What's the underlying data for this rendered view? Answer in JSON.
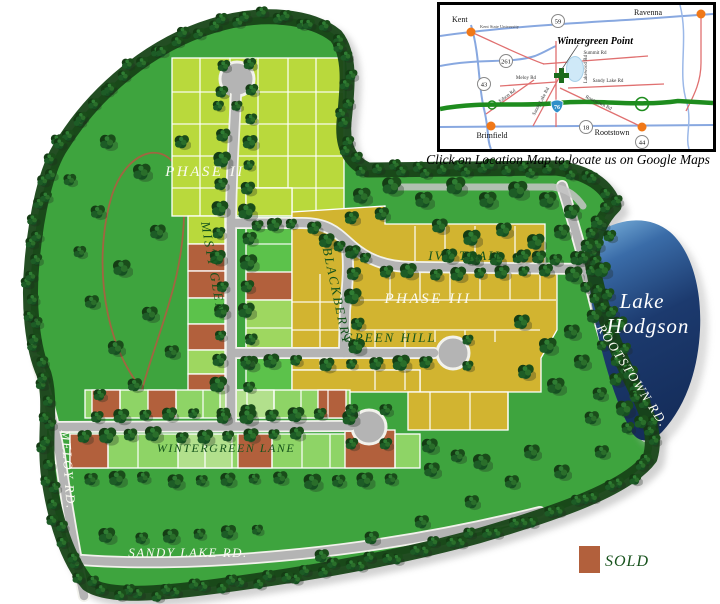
{
  "site_plan": {
    "phase2_label": "PHASE II",
    "phase3_label": "PHASE III",
    "streets": {
      "misty_glen": "MISTY GLEN",
      "blackberry": "BLACKBERRY",
      "ivy_trail": "IVY  TRAIL",
      "green_hill": "GREEN  HILL",
      "wintergreen_lane": "WINTERGREEN  LANE",
      "meloy_rd": "MELOY  RD.",
      "sandy_lake_rd": "SANDY  LAKE  RD.",
      "rootstown_rd": "ROOTSTOWN  RD."
    },
    "lake": {
      "line1": "Lake",
      "line2": "Hodgson"
    },
    "legend": {
      "sold_label": "SOLD",
      "sold_color": "#b2603c"
    },
    "colors": {
      "grass": "#3ea43e",
      "phase2_light": "#b9d93c",
      "phase2_green": "#5cc24b",
      "phase3_gold": "#d2b430",
      "sold": "#b2603c",
      "lake_blue": "#1c3a6b",
      "road_gray": "#b4b4b4"
    }
  },
  "location_map": {
    "caption": "Click on Location Map to locate us on Google Maps",
    "title": "Wintergreen Point",
    "cities": {
      "kent": "Kent",
      "ravenna": "Ravenna",
      "brimfield": "Brimfield",
      "rootstown": "Rootstown"
    },
    "landmark": "Kent State University",
    "roads": {
      "summit": "Summit Rd",
      "meloy": "Meloy Rd",
      "sandy_lake_e": "Sandy Lake Rd",
      "sandy_lake_n": "Sandy Lake Rd",
      "lakewood": "Lakewood Rd",
      "edson": "Edson Rd",
      "rootstown": "Rootstown Rd"
    },
    "routes": {
      "r59": "59",
      "r261": "261",
      "r43": "43",
      "r18": "18",
      "r44": "44",
      "i76": "76"
    }
  }
}
